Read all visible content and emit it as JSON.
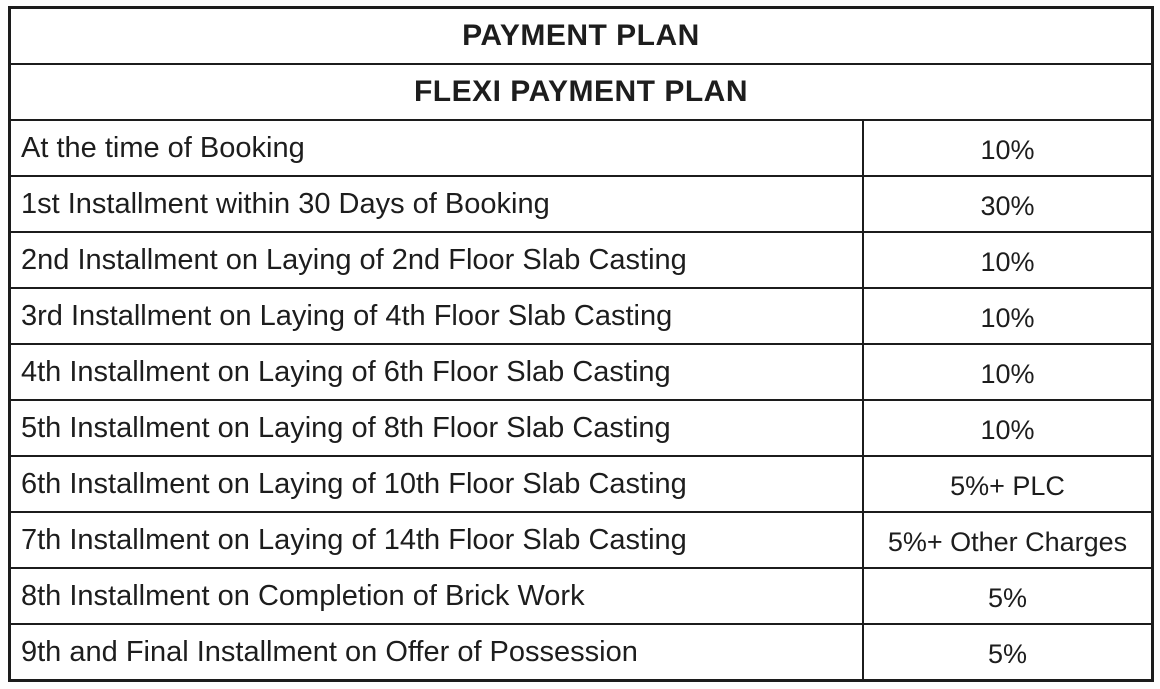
{
  "page": {
    "background_color": "#ffffff",
    "border_color": "#1c1c1c",
    "text_color": "#1d1d1d"
  },
  "table": {
    "title": "PAYMENT PLAN",
    "subtitle": "FLEXI PAYMENT PLAN",
    "rows": [
      {
        "label": "At the time of Booking",
        "value": "10%"
      },
      {
        "label": "1st Installment within 30 Days of Booking",
        "value": "30%"
      },
      {
        "label": "2nd Installment on Laying of 2nd Floor Slab Casting",
        "value": "10%"
      },
      {
        "label": "3rd Installment on Laying of 4th Floor Slab Casting",
        "value": "10%"
      },
      {
        "label": "4th Installment on Laying of 6th Floor Slab Casting",
        "value": "10%"
      },
      {
        "label": "5th Installment on Laying of 8th Floor Slab Casting",
        "value": "10%"
      },
      {
        "label": "6th Installment on Laying of 10th Floor Slab Casting",
        "value": "5%+ PLC"
      },
      {
        "label": "7th Installment on Laying of 14th Floor Slab Casting",
        "value": "5%+ Other Charges"
      },
      {
        "label": "8th Installment on Completion of Brick Work",
        "value": "5%"
      },
      {
        "label": "9th and Final Installment on Offer of Possession",
        "value": "5%"
      }
    ]
  }
}
